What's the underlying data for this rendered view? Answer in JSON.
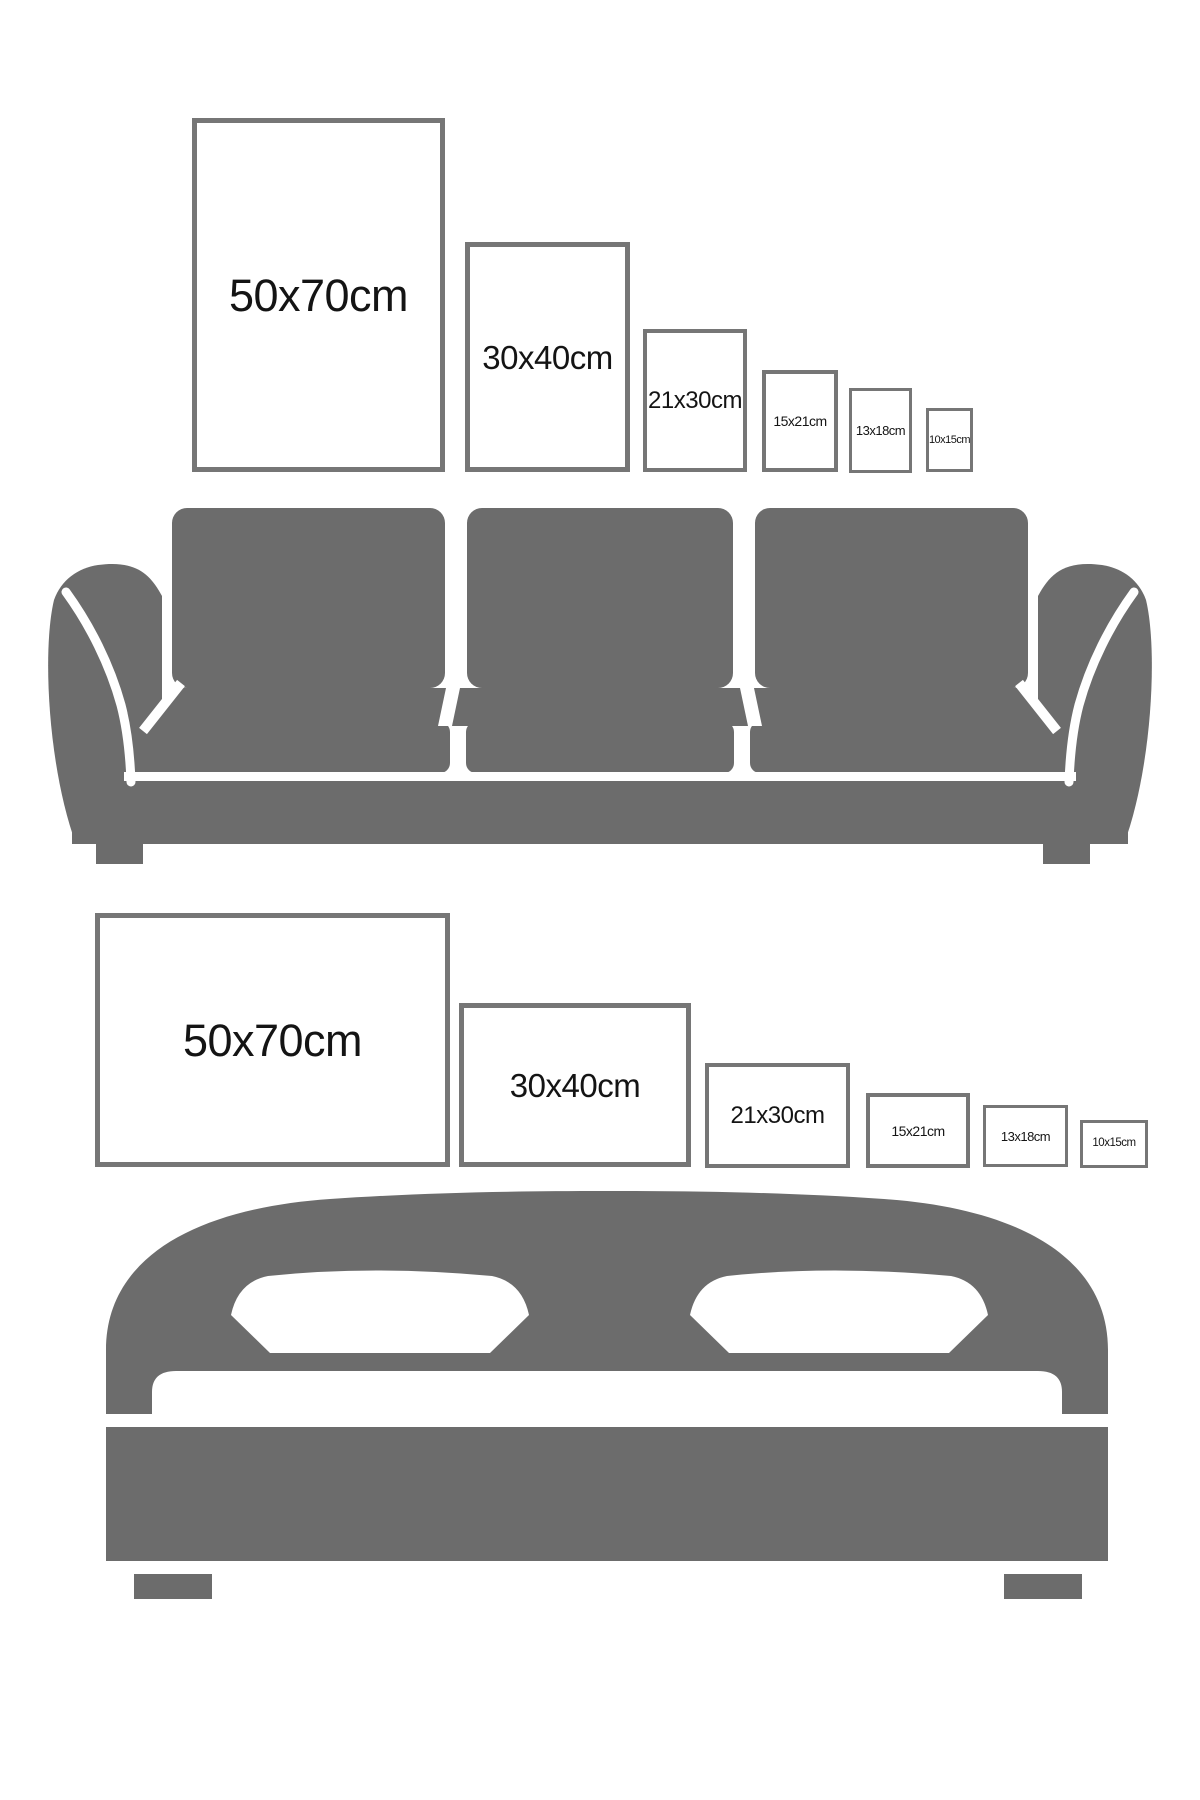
{
  "colors": {
    "furniture_gray": "#6c6c6c",
    "frame_border": "#767676",
    "frame_fill": "#ffffff",
    "label_text": "#141414",
    "background": "#ffffff"
  },
  "sections": [
    {
      "name": "sofa size comparison",
      "furniture_icon": "sofa-icon",
      "orientation": "portrait",
      "frames": [
        {
          "label": "50x70cm",
          "size": "50x70cm"
        },
        {
          "label": "30x40cm",
          "size": "30x40cm"
        },
        {
          "label": "21x30cm",
          "size": "21x30cm"
        },
        {
          "label": "15x21cm",
          "size": "15x21cm"
        },
        {
          "label": "13x18cm",
          "size": "13x18cm"
        },
        {
          "label": "10x15cm",
          "size": "10x15cm"
        }
      ]
    },
    {
      "name": "bed size comparison",
      "furniture_icon": "bed-icon",
      "orientation": "landscape",
      "frames": [
        {
          "label": "50x70cm",
          "size": "50x70cm"
        },
        {
          "label": "30x40cm",
          "size": "30x40cm"
        },
        {
          "label": "21x30cm",
          "size": "21x30cm"
        },
        {
          "label": "15x21cm",
          "size": "15x21cm"
        },
        {
          "label": "13x18cm",
          "size": "13x18cm"
        },
        {
          "label": "10x15cm",
          "size": "10x15cm"
        }
      ]
    }
  ]
}
